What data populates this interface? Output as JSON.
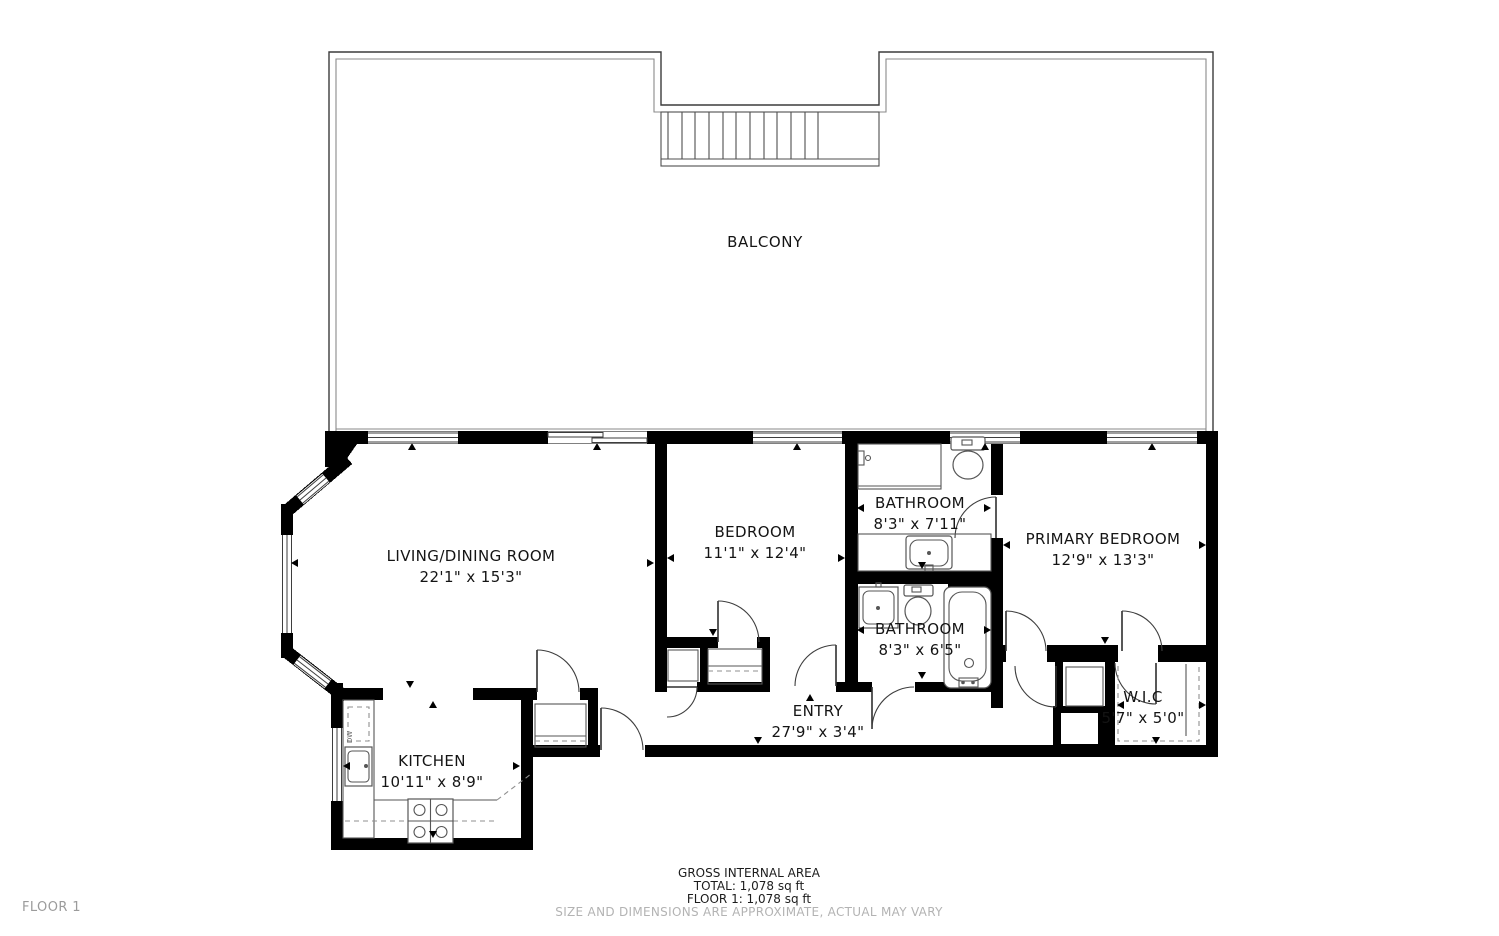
{
  "colors": {
    "wall": "#000000",
    "outline": "#3c3c3c",
    "fixture_line": "#565656",
    "dashed_line": "#8f8f8f",
    "text": "#141414",
    "muted_text": "#b3b3b3",
    "background": "#ffffff"
  },
  "balcony": {
    "label": "BALCONY"
  },
  "rooms": [
    {
      "id": "living",
      "name": "LIVING/DINING ROOM",
      "dims": "22'1\" x 15'3\""
    },
    {
      "id": "bedroom",
      "name": "BEDROOM",
      "dims": "11'1\" x 12'4\""
    },
    {
      "id": "bathroom1",
      "name": "BATHROOM",
      "dims": "8'3\" x 7'11\""
    },
    {
      "id": "primary",
      "name": "PRIMARY BEDROOM",
      "dims": "12'9\" x 13'3\""
    },
    {
      "id": "bathroom2",
      "name": "BATHROOM",
      "dims": "8'3\" x 6'5\""
    },
    {
      "id": "entry",
      "name": "ENTRY",
      "dims": "27'9\" x 3'4\""
    },
    {
      "id": "wic",
      "name": "W.I.C",
      "dims": "5'7\" x 5'0\""
    },
    {
      "id": "kitchen",
      "name": "KITCHEN",
      "dims": "10'11\" x 8'9\""
    }
  ],
  "appliance_labels": {
    "dishwasher": "DW"
  },
  "footer": {
    "title": "GROSS INTERNAL AREA",
    "total": "TOTAL: 1,078 sq ft",
    "floor": "FLOOR 1: 1,078 sq ft",
    "disclaimer": "SIZE AND DIMENSIONS ARE APPROXIMATE, ACTUAL MAY VARY"
  },
  "floor_label": "FLOOR 1"
}
